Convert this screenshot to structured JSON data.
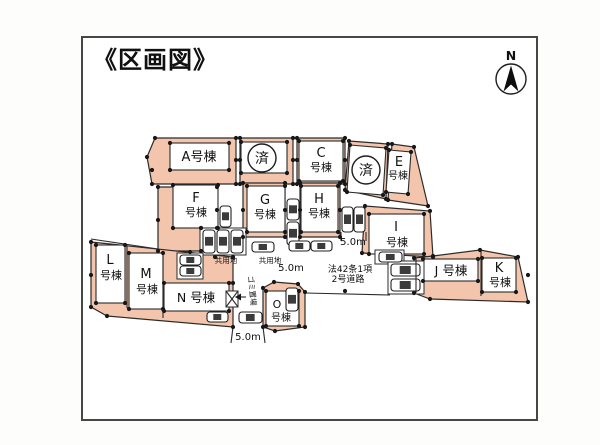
{
  "title": "《区画図》",
  "compass": {
    "north_label": "N"
  },
  "colors": {
    "lot_fill": "#f2c5ac",
    "outline": "#2b2b2b",
    "label_box": "#ffffff",
    "frame_border": "#474747",
    "background": "#ffffff"
  },
  "lots": {
    "A": {
      "label": "A号棟"
    },
    "B": {
      "status": "済"
    },
    "C": {
      "line1": "C",
      "line2": "号棟"
    },
    "D": {
      "status": "済"
    },
    "E": {
      "line1": "E",
      "line2": "号棟"
    },
    "F": {
      "line1": "F",
      "line2": "号棟"
    },
    "G": {
      "line1": "G",
      "line2": "号棟"
    },
    "H": {
      "line1": "H",
      "line2": "号棟"
    },
    "I": {
      "line1": "I",
      "line2": "号棟"
    },
    "J": {
      "label": "J 号棟"
    },
    "K": {
      "line1": "K",
      "line2": "号棟"
    },
    "L": {
      "line1": "L",
      "line2": "号棟"
    },
    "M": {
      "line1": "M",
      "line2": "号棟"
    },
    "N": {
      "label": "N 号棟"
    },
    "O": {
      "line1": "O",
      "line2": "号棟"
    }
  },
  "annotations": {
    "common_area_left": "共用地",
    "common_area_right": "共用地",
    "garbage_store": "ゴミ置場",
    "road_law_line1": "法42条1項",
    "road_law_line2": "2号道路",
    "dim_vertical_road": "5.0m",
    "dim_diagonal_road": "5.0m",
    "dim_bottom_road": "5.0m"
  }
}
